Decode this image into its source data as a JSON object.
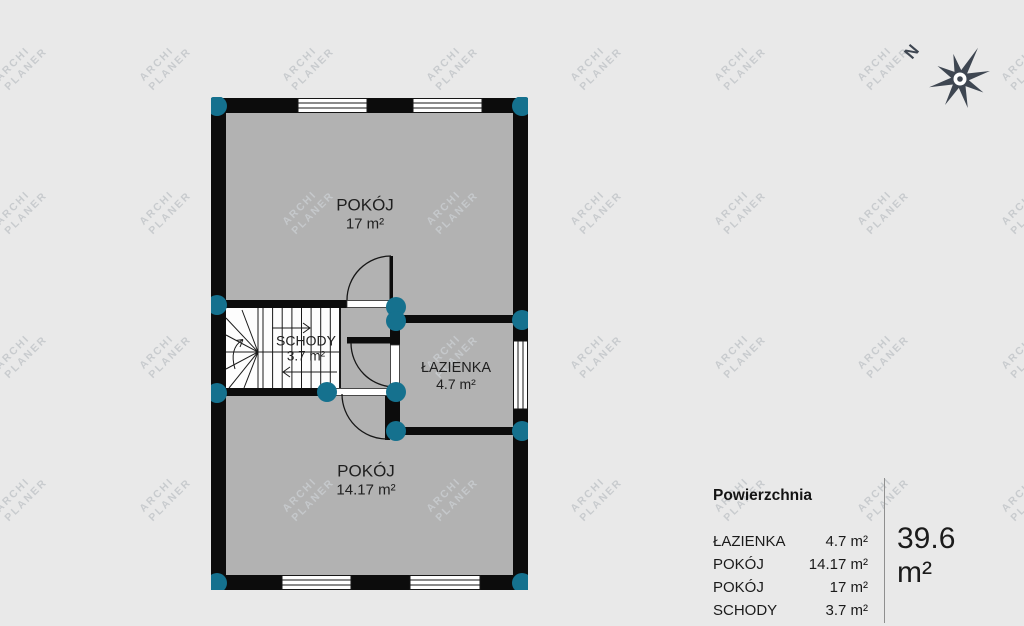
{
  "watermark": {
    "line1": "ARCHI",
    "line2": "PLANER"
  },
  "compass": {
    "north_label": "N"
  },
  "rooms": {
    "pokoj_top": {
      "name": "POKÓJ",
      "area": "17 m²"
    },
    "schody": {
      "name": "SCHODY",
      "area": "3.7 m²"
    },
    "lazienka": {
      "name": "ŁAZIENKA",
      "area": "4.7 m²"
    },
    "pokoj_bottom": {
      "name": "POKÓJ",
      "area": "14.17 m²"
    }
  },
  "legend": {
    "title": "Powierzchnia",
    "rows": [
      {
        "name": "ŁAZIENKA",
        "area": "4.7 m²"
      },
      {
        "name": "POKÓJ",
        "area": "14.17 m²"
      },
      {
        "name": "POKÓJ",
        "area": "17 m²"
      },
      {
        "name": "SCHODY",
        "area": "3.7 m²"
      }
    ],
    "total": "39.6 m²"
  },
  "colors": {
    "background": "#e9e9e9",
    "floor": "#b2b2b2",
    "wall": "#0c0c0c",
    "node": "#15718e",
    "watermark": "#c7cacd",
    "compass": "#3e4651"
  }
}
